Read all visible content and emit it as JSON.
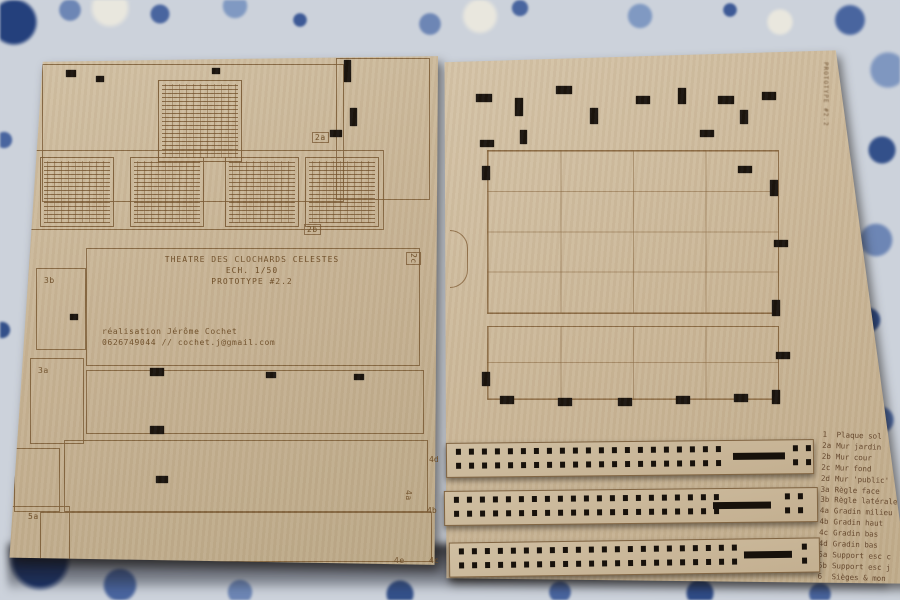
{
  "colors": {
    "board_light": "#d2c1a4",
    "board_mid": "#c7b394",
    "board_dark": "#bba887",
    "engraving": "#6e4e28",
    "cutout": "#17110b",
    "fabric_base": "#ccd2db",
    "fabric_blue_dark": "#24407c",
    "fabric_blue": "#49659f",
    "fabric_blue_light": "#8099c2"
  },
  "title_block": {
    "line1": "THEATRE DES CLOCHARDS CELESTES",
    "line2": "ECH. 1/50",
    "line3": "PROTOTYPE #2.2"
  },
  "contact_block": {
    "line1": "réalisation Jérôme Cochet",
    "line2": "0626749044 // cochet.j@gmail.com"
  },
  "part_labels": {
    "left_board": [
      "2a",
      "2b",
      "2c",
      "3b",
      "3a",
      "5a",
      "4a",
      "4e"
    ],
    "strips": [
      "4d",
      "4b",
      "4c"
    ]
  },
  "edge_text": "PROTOTYPE #2.2",
  "legend": {
    "items": [
      {
        "id": "1",
        "label": "Plaque sol"
      },
      {
        "id": "2a",
        "label": "Mur jardin"
      },
      {
        "id": "2b",
        "label": "Mur cour"
      },
      {
        "id": "2c",
        "label": "Mur fond"
      },
      {
        "id": "2d",
        "label": "Mur 'public'"
      },
      {
        "id": "3a",
        "label": "Règle face"
      },
      {
        "id": "3b",
        "label": "Règle latérale"
      },
      {
        "id": "4a",
        "label": "Gradin milieu"
      },
      {
        "id": "4b",
        "label": "Gradin haut"
      },
      {
        "id": "4c",
        "label": "Gradin bas"
      },
      {
        "id": "4d",
        "label": "Gradin bas"
      },
      {
        "id": "5a",
        "label": "Support esc c"
      },
      {
        "id": "5b",
        "label": "Support esc j"
      },
      {
        "id": "6",
        "label": "Sièges & mon"
      }
    ]
  }
}
